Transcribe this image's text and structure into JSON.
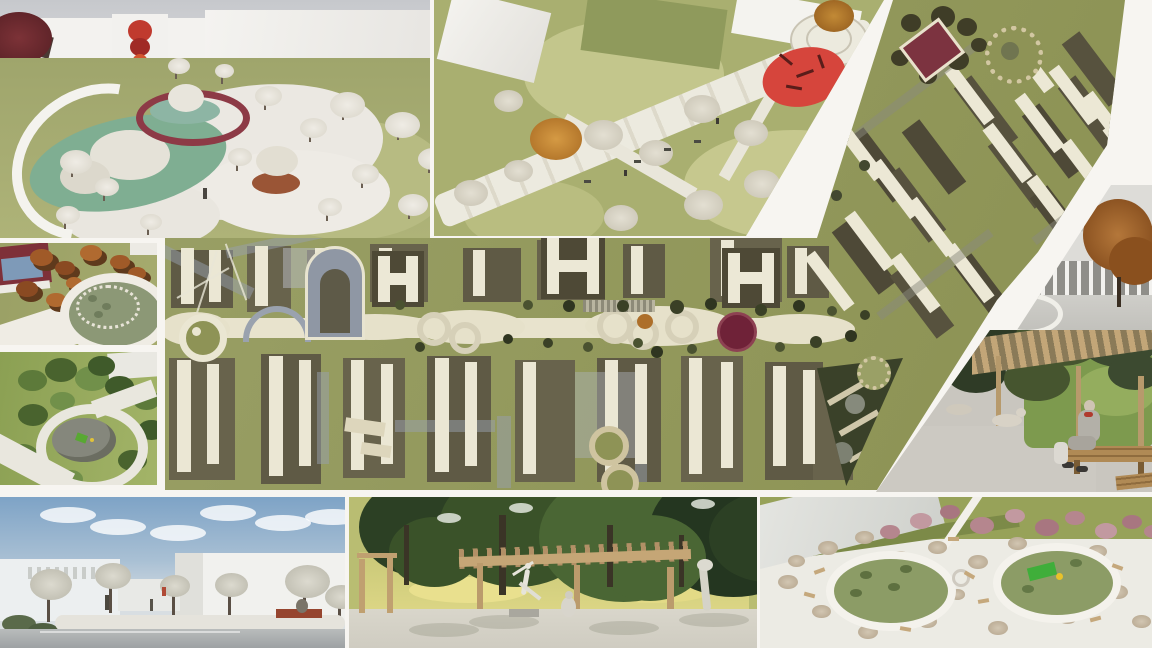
{
  "collage": {
    "kind": "landscape-architecture-render-collage",
    "visible_text": "",
    "palette": {
      "gutter_white": "#f7f5f1",
      "plan_olive": "#949a5e",
      "plan_dark_block": "#5f5a45",
      "plan_cream_slab": "#ebe7d4",
      "accent_red_canopy": "#d6453c",
      "ring_maroon": "#8d3a46",
      "pond_teal": "#7fae92",
      "autumn_orange": "#c28a36",
      "pink_blossom": "#b5868e",
      "lawn_green": "#a9af70",
      "sky_blue": "#7ea3c6",
      "wood_tan": "#c5a676",
      "play_green": "#3fae3a"
    },
    "panels": [
      {
        "id": "top-left",
        "name": "aerial-render-oval-ring-park",
        "description": "Aerial render: white buildings with red mural, maroon ring pavilion around teal pond, S-shaped teal water, white trees on olive lawn"
      },
      {
        "id": "top-middle",
        "name": "aerial-render-promenade",
        "description": "Aerial render: diagonal white promenade with pale trees, one orange tree, red organic canopy and circular plaza"
      },
      {
        "id": "masterplan",
        "name": "site-masterplan",
        "description": "Olive-green masterplan with cream building slabs, dark shadows, winding central corridor, red circular plaza, triangular grove; upper-right part tilted 3D aerial with red-roof pavilion and dotted circular plaza"
      },
      {
        "id": "middle-left-upper",
        "name": "aerial-render-red-pavilion-oval",
        "description": "Aerial render: red-roofed pavilion, autumn trees, oval ring plaza"
      },
      {
        "id": "middle-left-lower",
        "name": "aerial-render-circular-playground",
        "description": "Aerial render: green park, round grey plaza with play equipment, organic white path"
      },
      {
        "id": "right-wall",
        "name": "render-relief-wall-colonnade",
        "description": "Street render: light wall with sketch relief, thin colonnade, autumn tree"
      },
      {
        "id": "right-bench",
        "name": "render-pergola-bench-man",
        "description": "Render: man seated on wooden bench under pergola, dense green foliage, dog on path"
      },
      {
        "id": "bottom-left",
        "name": "render-pond-plaza",
        "description": "Eye-level render: blue sky, white buildings, grey-white trees, reflecting pond, red-brown bench"
      },
      {
        "id": "bottom-middle",
        "name": "render-sculpture-pergola-lawn",
        "description": "Render: shaded plaza with white dancer sculpture, wooden pergola, sunlit lawn, dark tree canopy"
      },
      {
        "id": "bottom-right",
        "name": "aerial-render-two-oval-playgrounds",
        "description": "Aerial render: white plaza with two green oval playgrounds, green slide, beige trees, row of pink blossom trees, pale building"
      }
    ]
  }
}
